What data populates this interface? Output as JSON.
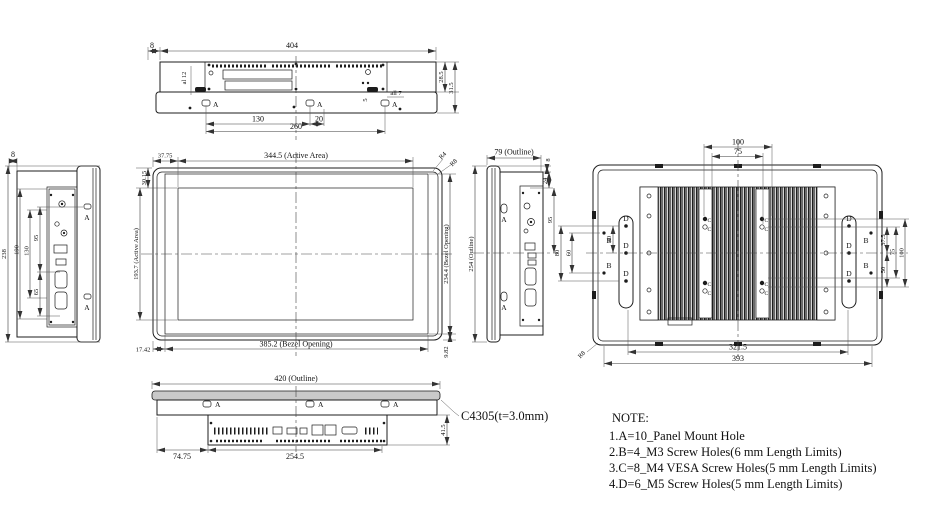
{
  "drawing": {
    "bg": "#ffffff",
    "line_color": "#1c1c1c",
    "labels": {
      "a": "A",
      "b": "B",
      "c": "C",
      "d": "D"
    },
    "top": {
      "w404": "404",
      "e8": "8",
      "hole12": "al 12",
      "hole7": "all 7",
      "hole5": "5",
      "h285": "28.5",
      "h315": "31.5",
      "s130": "130",
      "s20": "20",
      "s260": "260"
    },
    "left": {
      "e8": "8",
      "v238": "238",
      "v190": "190",
      "v130": "130",
      "v95": "95",
      "v65": "65"
    },
    "front": {
      "aw": "344.5 (Active Area)",
      "ah": "193.7 (Active Area)",
      "bw": "385.2 (Bezel Opening)",
      "bh": "234.4 (Bezel Opening)",
      "o_left": "37.75",
      "o_top": "30.15",
      "o_bot": "17.42",
      "o_right": "9.82",
      "r4": "R4",
      "r8": "R8"
    },
    "right": {
      "ow": "79 (Outline)",
      "oh": "254 (Outline)",
      "e8": "8",
      "v24": "24",
      "v95": "95"
    },
    "rear": {
      "t100": "100",
      "t75": "75",
      "l40": "40",
      "l80": "80",
      "l60": "60",
      "r375": "37.5",
      "r75": "75",
      "r100": "100",
      "r50": "50",
      "b3215": "321.5",
      "b393": "393",
      "r8": "R8"
    },
    "bottom": {
      "ow": "420 (Outline)",
      "b7475": "74.75",
      "b2545": "254.5",
      "v415": "41.5"
    },
    "callout": "C4305(t=3.0mm)",
    "note": {
      "heading": "NOTE:",
      "l1": "1.A=10_Panel Mount Hole",
      "l2": "2.B=4_M3 Screw Holes(6 mm Length Limits)",
      "l3": "3.C=8_M4 VESA Screw Holes(5 mm Length Limits)",
      "l4": "4.D=6_M5 Screw Holes(5 mm Length Limits)"
    }
  }
}
